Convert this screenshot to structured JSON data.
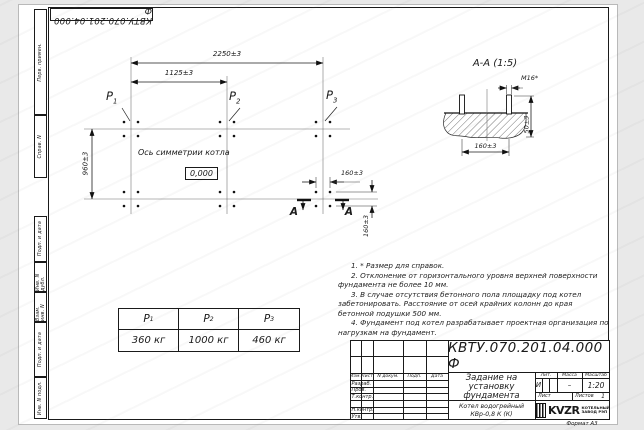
{
  "doc": {
    "number": "КВТУ.070.201.04.000 Ф",
    "format_label": "Формат А3"
  },
  "margin_fields": {
    "perv_primen": "Перв. примен.",
    "sprav_n": "Справ. N",
    "podp_data_1": "Подп. и дата",
    "inv_dubl": "Инв. N дубл.",
    "vzam_inv": "Взам. инв. N",
    "podp_data_2": "Подп. и дата",
    "inv_podl": "Инв. N подл."
  },
  "plan": {
    "dim_total_width": "2250±3",
    "dim_half_width": "1125±3",
    "dim_depth": "960±3",
    "dim_bolt_spacing_x": "160±3",
    "dim_bolt_spacing_y": "160±3",
    "axis_label": "Ось симметрии котла",
    "level_mark": "0,000",
    "loads": [
      {
        "sym": "P",
        "sub": "1"
      },
      {
        "sym": "P",
        "sub": "2"
      },
      {
        "sym": "P",
        "sub": "3"
      }
    ],
    "section_letter_left": "А",
    "section_letter_right": "А"
  },
  "section_view": {
    "title": "А-А (1:5)",
    "thread_size": "М16*",
    "dim_bolt_spacing": "160±3",
    "dim_protrusion": "50±3"
  },
  "notes": [
    "1. * Размер для справок.",
    "2. Отклонение от горизонтального уровня верхней поверхности фундамента не более 10 мм.",
    "3. В случае отсутствия бетонного пола площадку под котел забетонировать. Расстояние от осей крайних колонн до края бетонной подушки 500 мм.",
    "4. Фундамент под котел разрабатывает проектная организация по нагрузкам на фундамент."
  ],
  "load_table": {
    "headers": [
      {
        "sym": "P",
        "sub": "1"
      },
      {
        "sym": "P",
        "sub": "2"
      },
      {
        "sym": "P",
        "sub": "3"
      }
    ],
    "values": [
      "360 кг",
      "1000 кг",
      "460 кг"
    ]
  },
  "title_block": {
    "doc_number": "КВТУ.070.201.04.000 Ф",
    "title_lines": [
      "Задание на",
      "установку",
      "фундамента"
    ],
    "product_lines": [
      "Котел водогрейный",
      "КВр-0,8 К (К)"
    ],
    "header_cols": [
      "Изм.",
      "Лист",
      "N докум.",
      "Подп.",
      "Дата"
    ],
    "row_labels": [
      "Разраб.",
      "Пров.",
      "Т.контр.",
      "",
      "Н.контр.",
      "Утв."
    ],
    "lit_label": "Лит.",
    "lit_value": "И",
    "mass_label": "Масса",
    "mass_value": "–",
    "scale_label": "Масштаб",
    "scale_value": "1:20",
    "sheet_label": "Лист",
    "sheets_label": "Листов",
    "sheets_value": "1",
    "logo_text": "KVZR",
    "logo_caption_lines": [
      "КОТЕЛЬНЫЙ",
      "ЗАВОД РЭП"
    ]
  }
}
